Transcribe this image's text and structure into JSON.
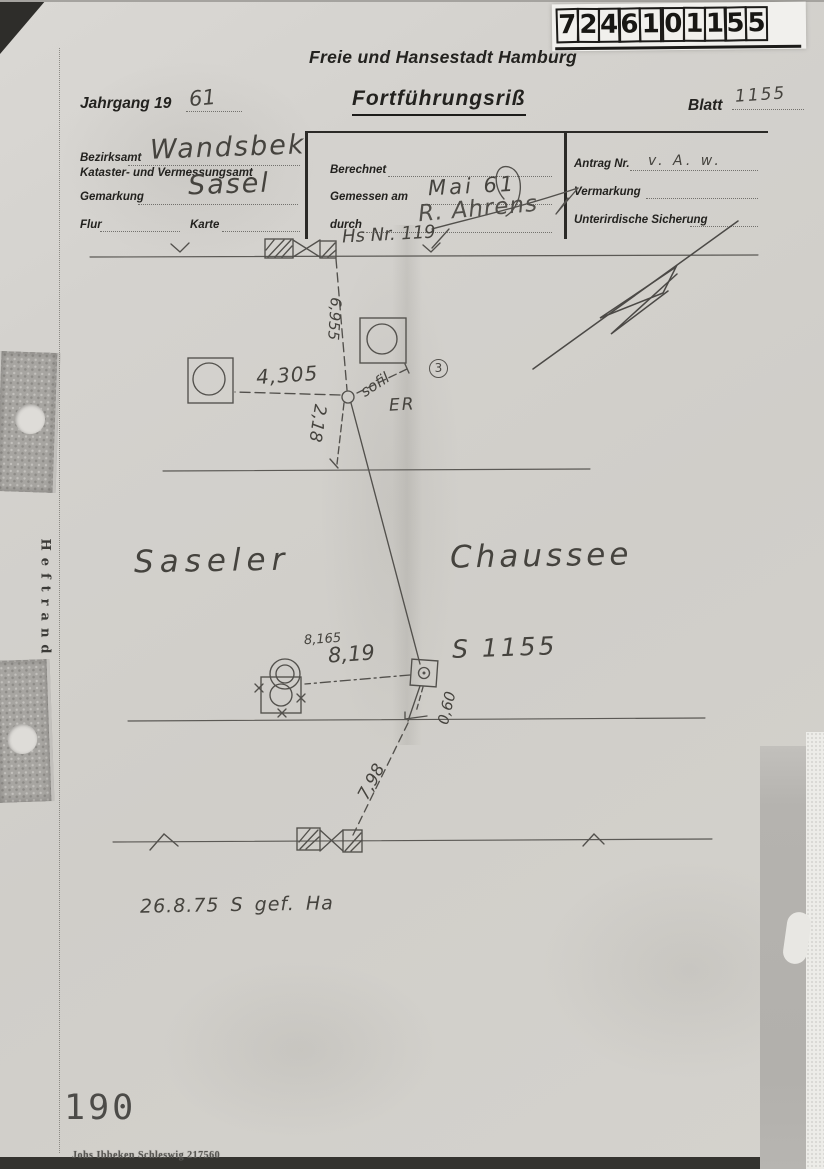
{
  "colors": {
    "paper": "#d2d0cb",
    "pencil": "#52504c",
    "print_ink": "#23221f",
    "handwriting": "#45433e"
  },
  "stamp_label": {
    "digits": [
      "7",
      "2",
      "4",
      "6",
      "1",
      "0",
      "1",
      "1",
      "5",
      "5"
    ]
  },
  "header": {
    "city": "Freie und Hansestadt Hamburg",
    "jahrgang_label": "Jahrgang 19",
    "jahrgang_value": "61",
    "title": "Fortführungsriß",
    "blatt_label": "Blatt",
    "blatt_value": "1155"
  },
  "form": {
    "bezirksamt_label": "Bezirksamt",
    "bezirksamt_value": "Wandsbek",
    "kataster_label": "Kataster- und Vermessungsamt",
    "gemarkung_label": "Gemarkung",
    "gemarkung_value": "Sasel",
    "flur_label": "Flur",
    "karte_label": "Karte",
    "berechnet_label": "Berechnet",
    "gemessen_label": "Gemessen am",
    "gemessen_value": "Mai 61",
    "durch_label": "durch",
    "durch_value": "R. Ahrens",
    "antrag_label": "Antrag Nr.",
    "antrag_value": "v. A. w.",
    "vermarkung_label": "Vermarkung",
    "sicherung_label": "Unterirdische Sicherung"
  },
  "sketch": {
    "house_note": "Hs Nr. 119",
    "street_left": "Saseler",
    "street_right": "Chaussee",
    "point_label": "S 1155",
    "diagonal_note": "sofil",
    "er_note": "ER",
    "circled_number": "3",
    "meas_top": "6,955",
    "meas_left": "4,305",
    "meas_down": "2,18",
    "meas_mid_small": "8,165",
    "meas_mid": "8,19",
    "meas_offset": "0,60",
    "meas_bottom": "7,98",
    "date_note": "26.8.75   S gef.   Ha"
  },
  "margin": {
    "heftrand": "Heftrand",
    "page_number": "190",
    "printer_imprint": "Johs Ibbeken Schleswig 217560"
  }
}
